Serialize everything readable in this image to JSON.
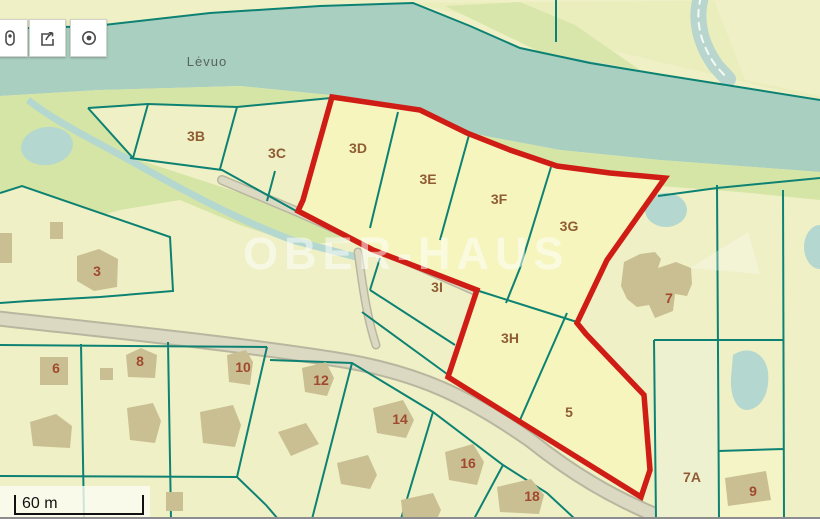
{
  "app": {
    "watermark_text": "OBER-HAUS"
  },
  "toolbar": {
    "buttons": [
      {
        "name": "marker",
        "icon": "map-marker-icon"
      },
      {
        "name": "share",
        "icon": "share-icon"
      },
      {
        "name": "locate",
        "icon": "locate-icon"
      }
    ]
  },
  "scale_bar": {
    "label": "60 m"
  },
  "map": {
    "river_label": "Lėvuo",
    "parcels": [
      {
        "label": "3B"
      },
      {
        "label": "3C"
      },
      {
        "label": "3D"
      },
      {
        "label": "3E"
      },
      {
        "label": "3F"
      },
      {
        "label": "3G"
      },
      {
        "label": "3I"
      },
      {
        "label": "3H"
      },
      {
        "label": "5"
      },
      {
        "label": "3"
      },
      {
        "label": "6"
      },
      {
        "label": "8"
      },
      {
        "label": "10"
      },
      {
        "label": "12"
      },
      {
        "label": "14"
      },
      {
        "label": "16"
      },
      {
        "label": "18"
      },
      {
        "label": "7"
      },
      {
        "label": "7A"
      },
      {
        "label": "9"
      }
    ],
    "colors": {
      "selection_red": "#cf1d15",
      "boundary_teal": "#0d8273",
      "water": "#a9cfc1",
      "bank_green": "#d5e5a6",
      "parcel_yellow": "#eff0c5",
      "selected_parcel_yellow": "#f5f5bd",
      "building_tan": "#c9bf92",
      "road_gray": "#dcd9c3"
    }
  }
}
